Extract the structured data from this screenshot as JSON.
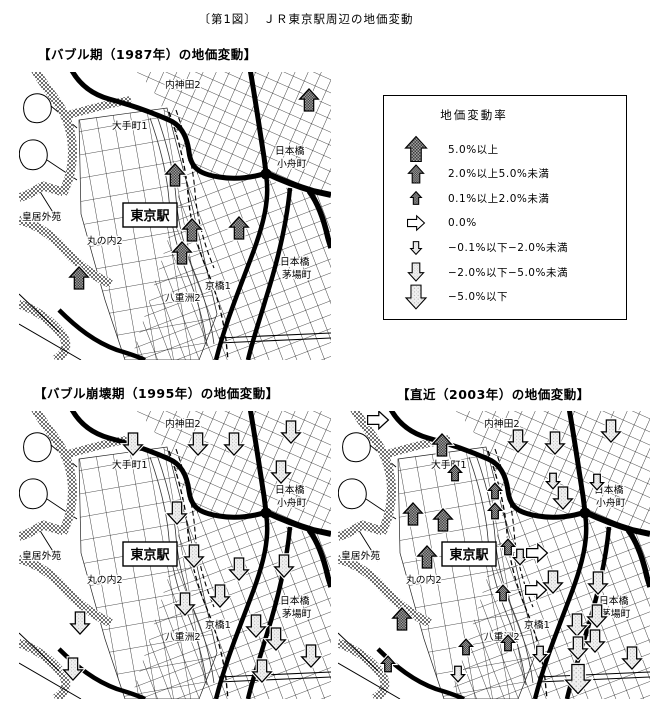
{
  "page_title": "〔第1図〕　ＪＲ東京駅周辺の地価変動",
  "colors": {
    "ink": "#000000",
    "paper": "#ffffff",
    "up_arrow_fill": "#8f8f8f",
    "down_arrow_fill": "#ededed",
    "flat_arrow_fill": "#ffffff"
  },
  "legend": {
    "title": "地価変動率",
    "items": [
      {
        "type": "up3",
        "label": "5.0%以上"
      },
      {
        "type": "up2",
        "label": "2.0%以上5.0%未満"
      },
      {
        "type": "up1",
        "label": "0.1%以上2.0%未満"
      },
      {
        "type": "flat",
        "label": "0.0%"
      },
      {
        "type": "down1",
        "label": "−0.1%以下−2.0%未満"
      },
      {
        "type": "down2",
        "label": "−2.0%以下−5.0%未満"
      },
      {
        "type": "down3",
        "label": "−5.0%以下"
      }
    ]
  },
  "base_map": {
    "station_label": "東京駅",
    "labels": [
      {
        "text": "内神田2",
        "x": 146,
        "y": 16
      },
      {
        "text": "大手町1",
        "x": 93,
        "y": 57
      },
      {
        "text": "日本橋",
        "x": 256,
        "y": 82
      },
      {
        "text": "小舟町",
        "x": 258,
        "y": 95
      },
      {
        "text": "皇居外苑",
        "x": 3,
        "y": 148
      },
      {
        "text": "丸の内2",
        "x": 68,
        "y": 172
      },
      {
        "text": "京橋1",
        "x": 186,
        "y": 217
      },
      {
        "text": "八重洲2",
        "x": 146,
        "y": 229
      },
      {
        "text": "日本橋",
        "x": 261,
        "y": 193
      },
      {
        "text": "茅場町",
        "x": 263,
        "y": 206
      }
    ]
  },
  "maps": [
    {
      "id": "map-1987",
      "title": "【バブル期（1987年）の地価変動】",
      "arrows": [
        {
          "t": "up2",
          "x": 290,
          "y": 28
        },
        {
          "t": "up2",
          "x": 156,
          "y": 103
        },
        {
          "t": "up2",
          "x": 173,
          "y": 158
        },
        {
          "t": "up2",
          "x": 220,
          "y": 156
        },
        {
          "t": "up2",
          "x": 163,
          "y": 181
        },
        {
          "t": "up2",
          "x": 60,
          "y": 206
        }
      ]
    },
    {
      "id": "map-1995",
      "title": "【バブル崩壊期（1995年）の地価変動】",
      "arrows": [
        {
          "t": "down2",
          "x": 114,
          "y": 33
        },
        {
          "t": "down2",
          "x": 179,
          "y": 33
        },
        {
          "t": "down2",
          "x": 215,
          "y": 33
        },
        {
          "t": "down2",
          "x": 272,
          "y": 21
        },
        {
          "t": "down2",
          "x": 262,
          "y": 61
        },
        {
          "t": "down2",
          "x": 158,
          "y": 102
        },
        {
          "t": "down2",
          "x": 175,
          "y": 145
        },
        {
          "t": "down2",
          "x": 220,
          "y": 158
        },
        {
          "t": "down2",
          "x": 265,
          "y": 155
        },
        {
          "t": "down2",
          "x": 201,
          "y": 185
        },
        {
          "t": "down2",
          "x": 166,
          "y": 193
        },
        {
          "t": "down2",
          "x": 61,
          "y": 212
        },
        {
          "t": "down2",
          "x": 237,
          "y": 215
        },
        {
          "t": "down2",
          "x": 257,
          "y": 228
        },
        {
          "t": "down2",
          "x": 292,
          "y": 245
        },
        {
          "t": "down2",
          "x": 54,
          "y": 258
        },
        {
          "t": "down2",
          "x": 243,
          "y": 260
        }
      ]
    },
    {
      "id": "map-2003",
      "title": "【直近（2003年）の地価変動】",
      "arrows": [
        {
          "t": "flat",
          "x": 40,
          "y": 9
        },
        {
          "t": "up2",
          "x": 104,
          "y": 34
        },
        {
          "t": "down2",
          "x": 180,
          "y": 30
        },
        {
          "t": "down2",
          "x": 217,
          "y": 32
        },
        {
          "t": "down2",
          "x": 273,
          "y": 20
        },
        {
          "t": "up1",
          "x": 117,
          "y": 62
        },
        {
          "t": "up1",
          "x": 157,
          "y": 80
        },
        {
          "t": "down1",
          "x": 215,
          "y": 70
        },
        {
          "t": "down2",
          "x": 225,
          "y": 87
        },
        {
          "t": "down1",
          "x": 259,
          "y": 71
        },
        {
          "t": "up2",
          "x": 75,
          "y": 103
        },
        {
          "t": "up2",
          "x": 105,
          "y": 109
        },
        {
          "t": "up1",
          "x": 157,
          "y": 100
        },
        {
          "t": "up2",
          "x": 89,
          "y": 146
        },
        {
          "t": "up1",
          "x": 170,
          "y": 136
        },
        {
          "t": "down1",
          "x": 182,
          "y": 146
        },
        {
          "t": "flat",
          "x": 199,
          "y": 142
        },
        {
          "t": "down2",
          "x": 215,
          "y": 171
        },
        {
          "t": "flat",
          "x": 198,
          "y": 179
        },
        {
          "t": "up1",
          "x": 165,
          "y": 182
        },
        {
          "t": "down2",
          "x": 260,
          "y": 172
        },
        {
          "t": "up2",
          "x": 64,
          "y": 208
        },
        {
          "t": "down2",
          "x": 239,
          "y": 214
        },
        {
          "t": "down2",
          "x": 259,
          "y": 205
        },
        {
          "t": "down2",
          "x": 257,
          "y": 230
        },
        {
          "t": "down2",
          "x": 240,
          "y": 237
        },
        {
          "t": "up1",
          "x": 128,
          "y": 236
        },
        {
          "t": "up1",
          "x": 170,
          "y": 232
        },
        {
          "t": "down1",
          "x": 202,
          "y": 243
        },
        {
          "t": "up1",
          "x": 50,
          "y": 253
        },
        {
          "t": "down1",
          "x": 120,
          "y": 263
        },
        {
          "t": "down3",
          "x": 240,
          "y": 268
        },
        {
          "t": "down2",
          "x": 294,
          "y": 247
        }
      ]
    }
  ]
}
